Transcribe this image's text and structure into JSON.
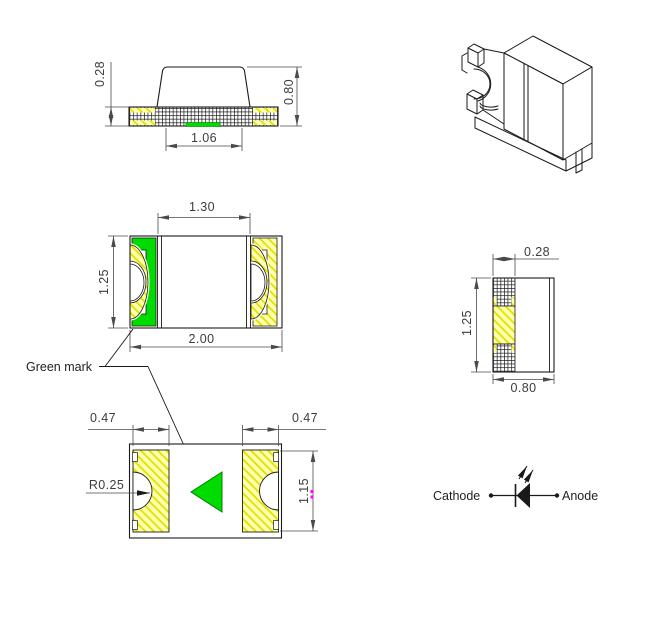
{
  "drawing": {
    "subject": "SMD chip LED package outline drawing"
  },
  "colors": {
    "pad_yellow": "#FFFFB0",
    "hatch_yellow": "#E0E000",
    "mark_green": "#00DC00",
    "line": "#1A1A1A",
    "dim_line": "#4A4A4A",
    "grip_magenta": "#FF00FF"
  },
  "views": {
    "side": {
      "dim_thickness": "0.28",
      "dim_height": "0.80",
      "dim_bottom_gap": "1.06"
    },
    "top": {
      "dim_inner_width": "1.30",
      "dim_depth": "1.25",
      "dim_width": "2.00"
    },
    "end": {
      "dim_terminal_width": "0.28",
      "dim_depth": "1.25",
      "dim_width": "0.80"
    },
    "bottom": {
      "dim_pad_left": "0.47",
      "dim_pad_right": "0.47",
      "dim_notch_radius": "R0.25",
      "dim_pad_length": "1.15"
    },
    "polarity": {
      "cathode": "Cathode",
      "anode": "Anode"
    }
  },
  "annotations": {
    "green_mark": "Green mark"
  }
}
